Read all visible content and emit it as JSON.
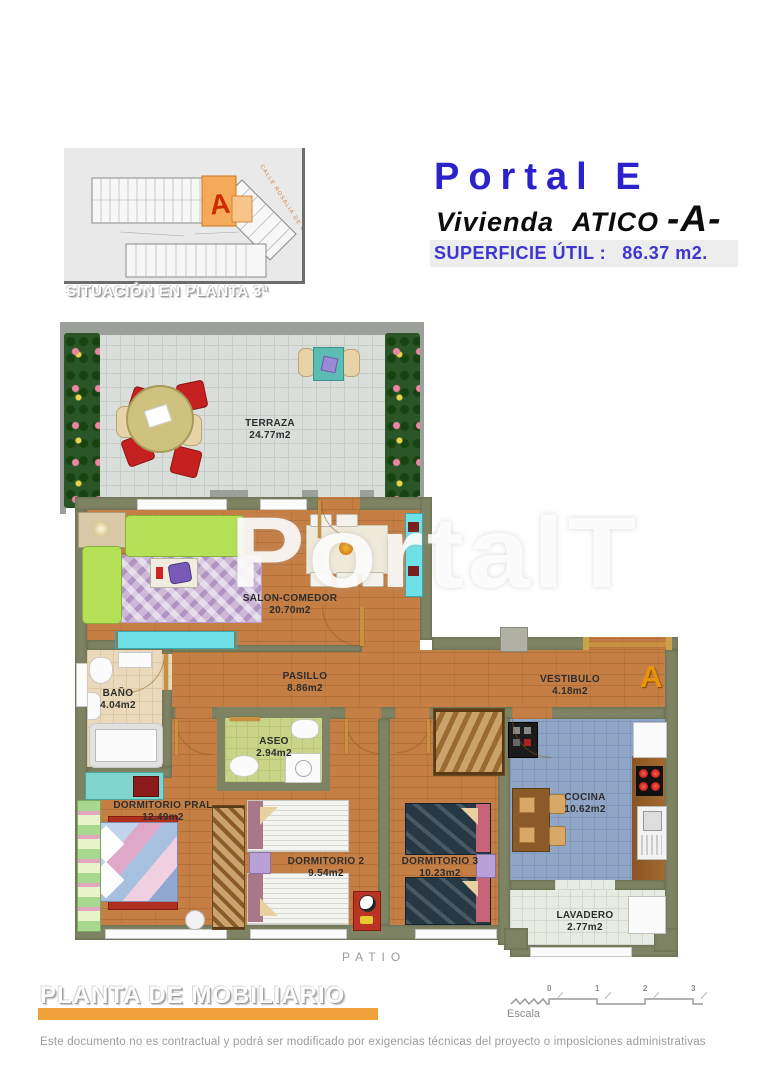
{
  "situation": {
    "caption": "SITUACIÓN EN PLANTA 3ª",
    "street_label": "CALLE ROSALIA DE CASTRO",
    "unit_letter": "A"
  },
  "header": {
    "portal": "Portal E",
    "vivienda_label": "Vivienda",
    "tipo": "ATICO",
    "unit": "-A-",
    "superficie_label": "SUPERFICIE ÚTIL :",
    "superficie_value": "86.37 m2."
  },
  "plan": {
    "watermark": "PortalT",
    "entrance_letter": "A",
    "patio_label": "PATIO",
    "rooms": {
      "terraza": {
        "name": "TERRAZA",
        "area": "24.77m2"
      },
      "salon": {
        "name": "SALON-COMEDOR",
        "area": "20.70m2"
      },
      "pasillo": {
        "name": "PASILLO",
        "area": "8.86m2"
      },
      "bano": {
        "name": "BAÑO",
        "area": "4.04m2"
      },
      "aseo": {
        "name": "ASEO",
        "area": "2.94m2"
      },
      "vestibulo": {
        "name": "VESTIBULO",
        "area": "4.18m2"
      },
      "dorm_pral": {
        "name": "DORMITORIO PRAL",
        "area": "12.49m2"
      },
      "dorm2": {
        "name": "DORMITORIO 2",
        "area": "9.54m2"
      },
      "dorm3": {
        "name": "DORMITORIO 3",
        "area": "10.23m2"
      },
      "cocina": {
        "name": "COCINA",
        "area": "10.62m2"
      },
      "lavadero": {
        "name": "LAVADERO",
        "area": "2.77m2"
      }
    }
  },
  "footer": {
    "heading": "PLANTA DE MOBILIARIO",
    "scale_label": "Escala",
    "scale_ticks": [
      "0",
      "1",
      "2",
      "3"
    ],
    "disclaimer": "Este documento no es contractual y podrá ser modificado por exigencias técnicas del proyecto o imposiciones administrativas"
  },
  "colors": {
    "header_blue": "#2c22cb",
    "accent_orange": "#f2a23b",
    "highlight_unit_orange": "#f0a050",
    "unit_letter_red": "#cc2200",
    "wall_olive": "#7d8363",
    "wood_floor": "#c57f45",
    "kitchen_tile_blue": "#8fa6c6",
    "aseo_green": "#c9d488",
    "bano_beige": "#ead9ba",
    "sofa_green": "#b4e156",
    "entrance_letter_orange": "#e8930c"
  }
}
